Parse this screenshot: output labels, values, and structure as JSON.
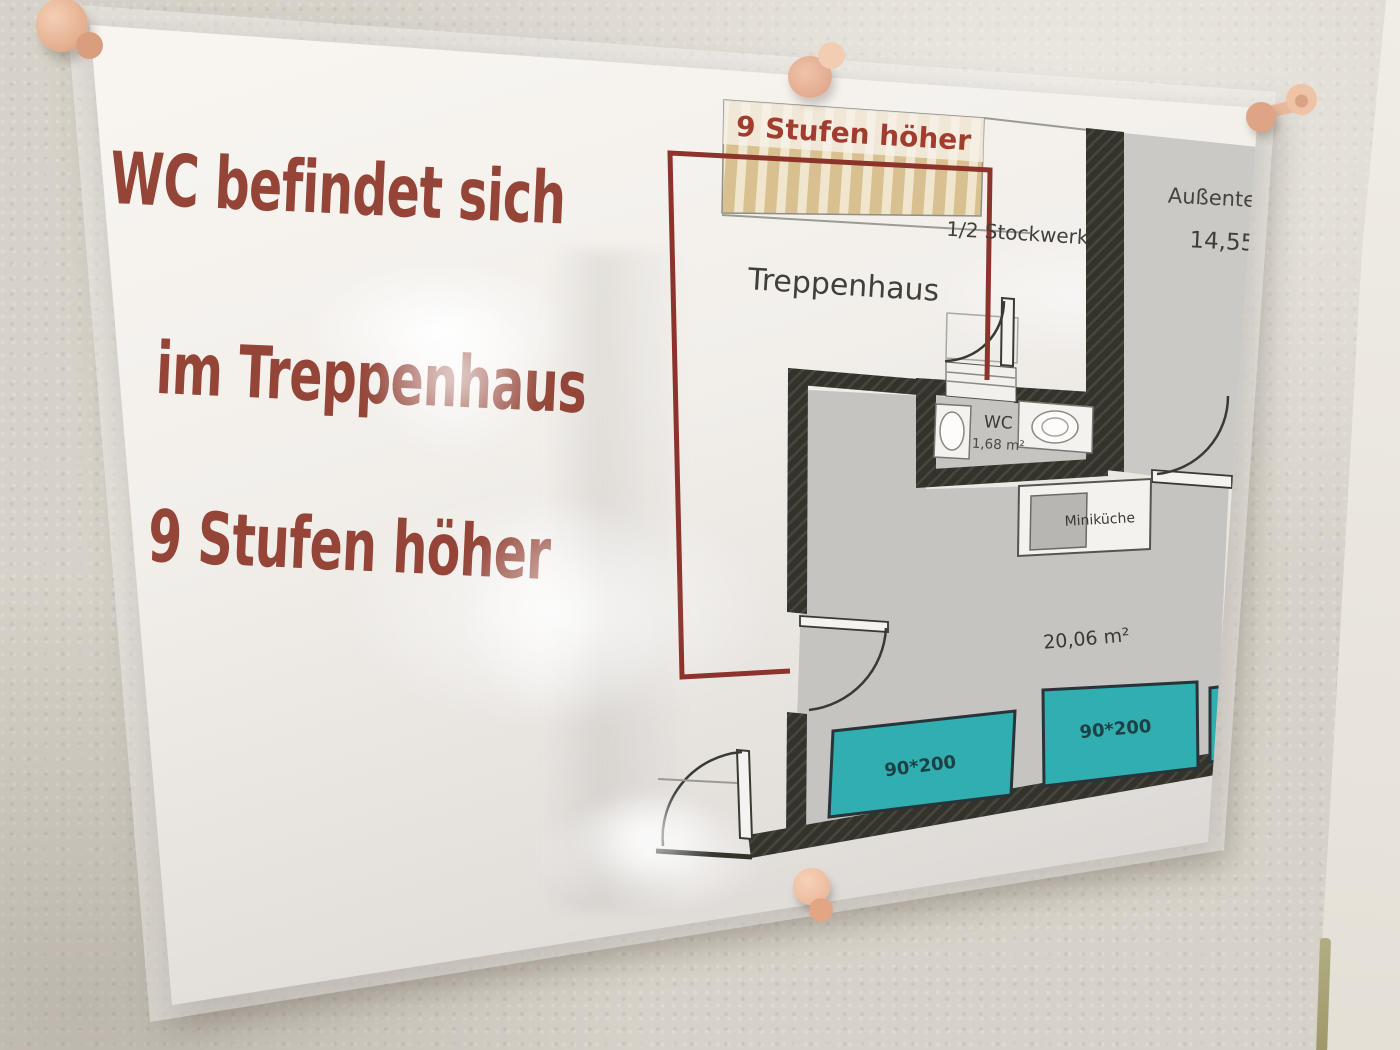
{
  "sign": {
    "lines": [
      "WC befindet sich",
      "im Treppenhaus",
      "9 Stufen höher"
    ],
    "text_color": "#944538"
  },
  "floor_plan": {
    "stairs_label": "9 Stufen höher",
    "staircase_label": "Treppenhaus",
    "half_floor_label": "1/2 Stockwerk",
    "terrace_label": "Außenter",
    "terrace_area": "14,55",
    "wc_label": "WC",
    "wc_area": "1,68 m²",
    "kitchenette_label": "Miniküche",
    "room_area": "20,06 m²",
    "beds": [
      {
        "label": "90*200"
      },
      {
        "label": "90*200"
      }
    ],
    "bed_color": "#31aeb0",
    "highlight_color": "#8c332c",
    "wall_color": "#33332c"
  },
  "pins": {
    "icon": "pushpin-icon",
    "color": "#eab89c",
    "visible_count": 4
  }
}
